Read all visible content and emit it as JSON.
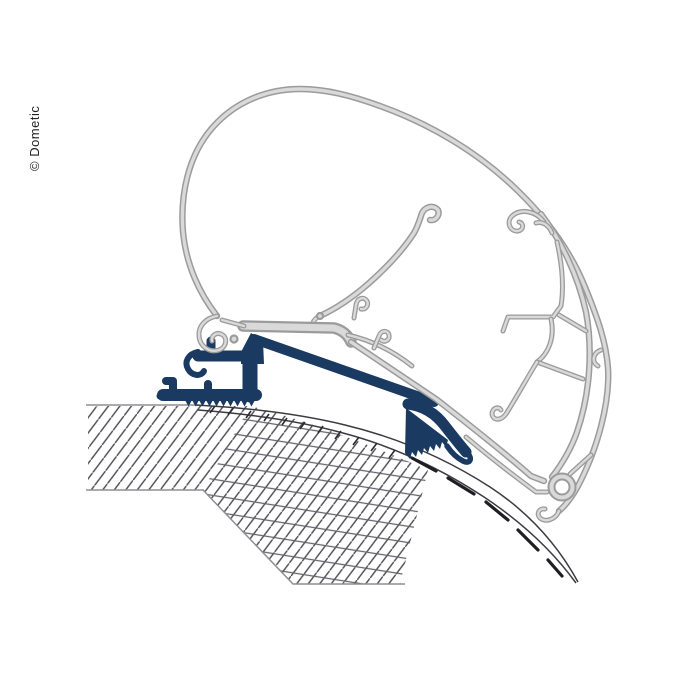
{
  "watermark": {
    "text": "© Dometic"
  },
  "colors": {
    "background": "#ffffff",
    "profile_edge": "#9b9b9b",
    "profile_fill": "#d9d9d9",
    "adapter_blue": "#1a3a62",
    "hatch_line": "#4b4b52",
    "cross_hatch_line": "#62626a",
    "hatch_edge": "#8f8f94",
    "roof_line": "#3b3b42",
    "roof_tick": "#2a2a30",
    "roof_core": "#1e1e24",
    "watermark_text": "#1f1f1f"
  }
}
